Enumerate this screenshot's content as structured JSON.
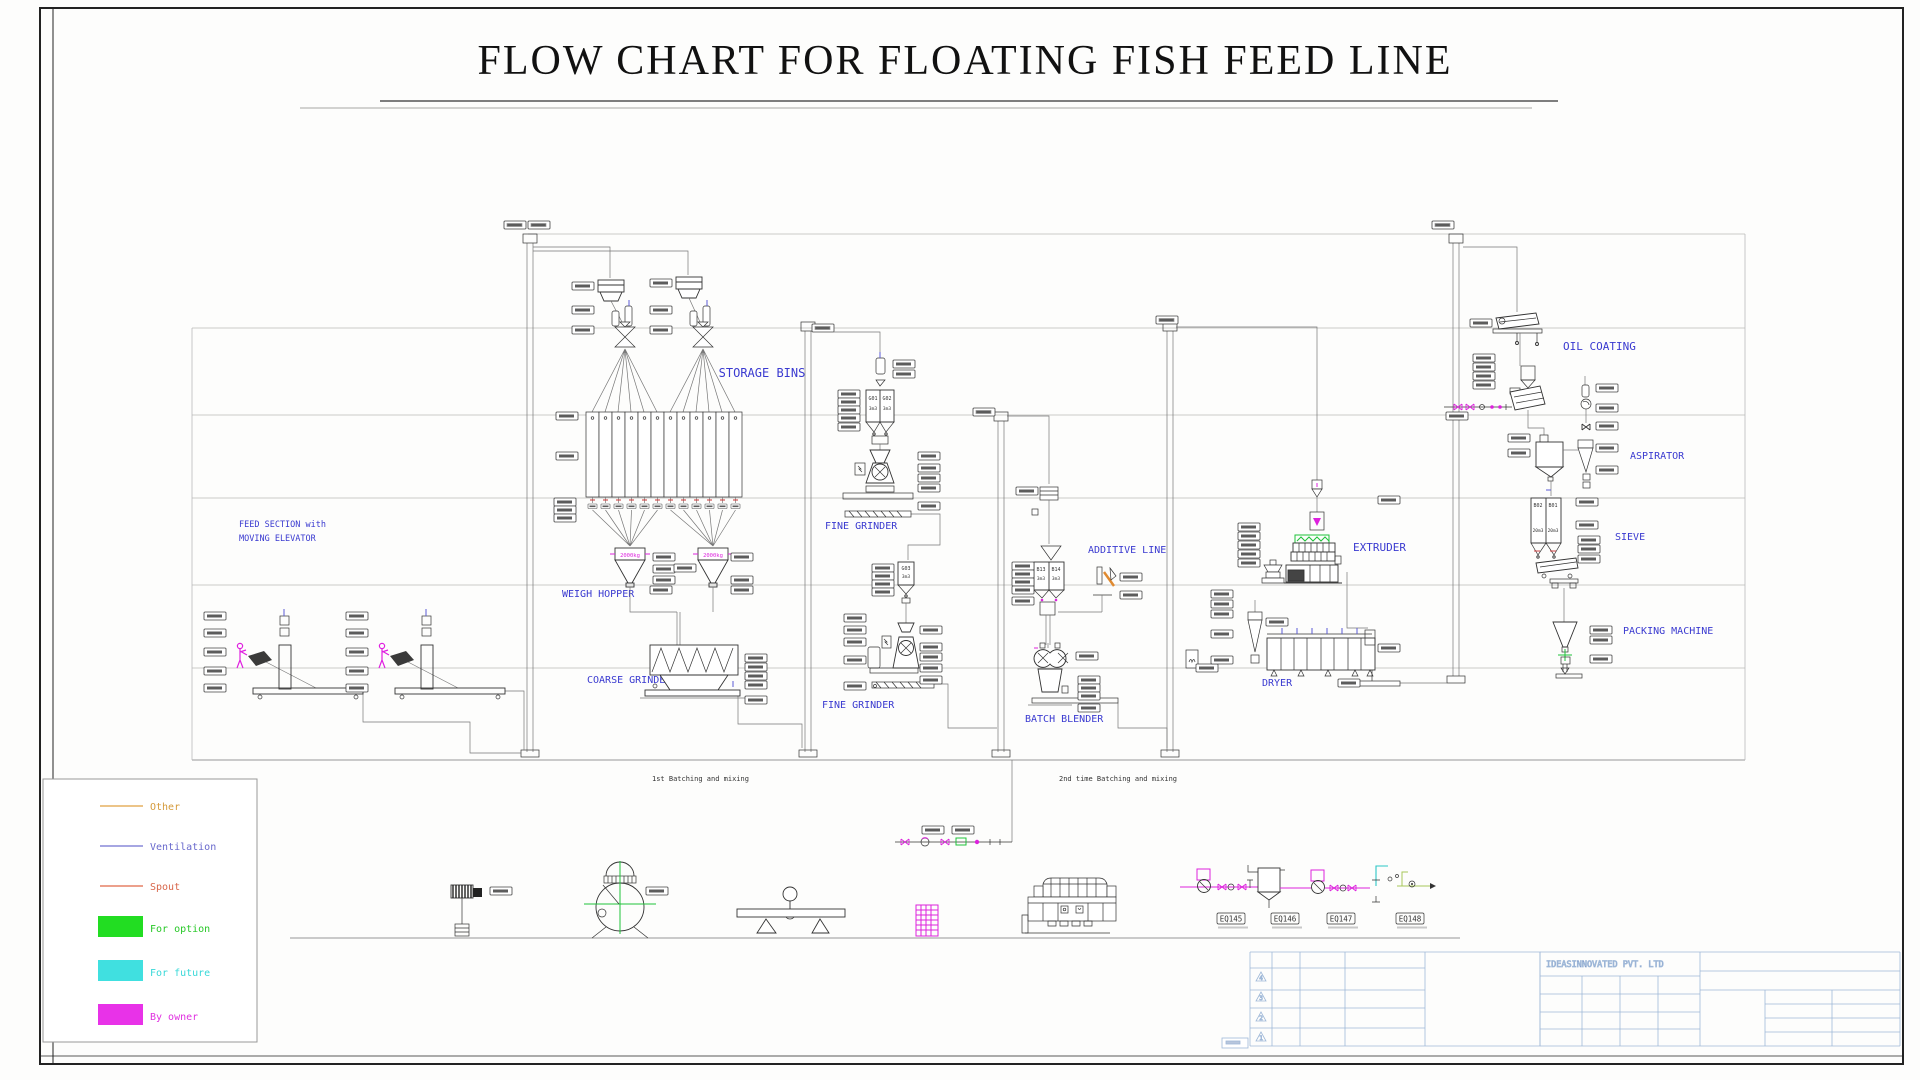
{
  "title": "FLOW CHART FOR  FLOATING FISH FEED LINE",
  "sections": {
    "feed_line1": "FEED SECTION with",
    "feed_line2": "MOVING ELEVATOR",
    "storage_bins": "STORAGE BINS",
    "weigh_hopper": "WEIGH HOPPER",
    "coarse_grinder": "COARSE GRINDER",
    "fine_grinder_upper": "FINE GRINDER",
    "fine_grinder_lower": "FINE GRINDER",
    "additive_line": "ADDITIVE LINE",
    "batch_blender": "BATCH BLENDER",
    "extruder": "EXTRUDER",
    "dryer": "DRYER",
    "oil_coating": "OIL COATING",
    "aspirator": "ASPIRATOR",
    "sieve": "SIEVE",
    "packing_machine": "PACKING MACHINE"
  },
  "zones": {
    "first": "1st Batching and mixing",
    "second": "2nd time Batching and mixing"
  },
  "legend": {
    "items": [
      {
        "label": "Other",
        "type": "line",
        "color": "#E0A040"
      },
      {
        "label": "Ventilation",
        "type": "line",
        "color": "#7070D0"
      },
      {
        "label": "Spout",
        "type": "line",
        "color": "#E06848"
      },
      {
        "label": "For option",
        "type": "swatch",
        "color": "#22DD22"
      },
      {
        "label": "For future",
        "type": "swatch",
        "color": "#40E0E0"
      },
      {
        "label": "By owner",
        "type": "swatch",
        "color": "#E832E8"
      }
    ]
  },
  "vessels": {
    "weigh_a": "2000kg",
    "weigh_b": "2000kg",
    "g01": "G01",
    "g02": "G02",
    "g03": "G03",
    "g_vol": "3m3",
    "b13": "B13",
    "b14": "B14",
    "b_vol": "3m3",
    "b02": "B02",
    "b01": "B01",
    "bin_vol": "20m3"
  },
  "bottom_row": {
    "eq145": "EQ145",
    "eq146": "EQ146",
    "eq147": "EQ147",
    "eq148": "EQ148"
  },
  "title_block": {
    "company": "IDEASINNOVATED PVT. LTD",
    "revisions": [
      "4",
      "3",
      "2",
      "1"
    ]
  }
}
